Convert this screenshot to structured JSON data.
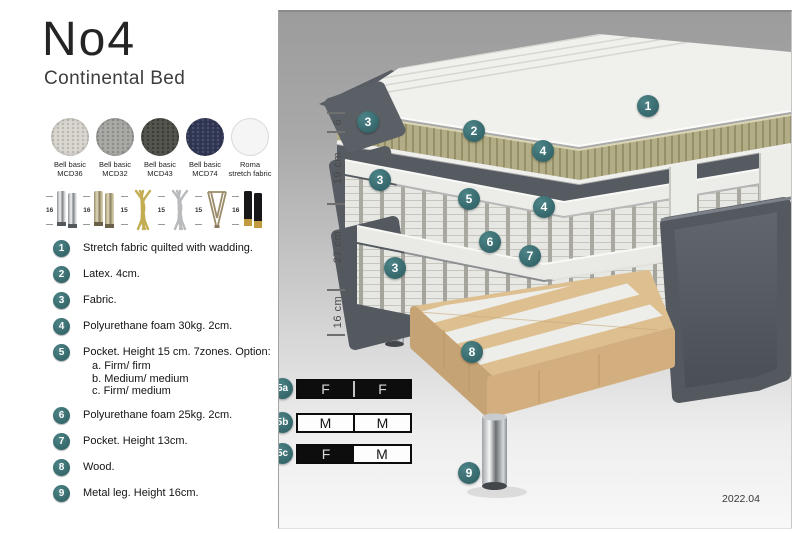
{
  "product": {
    "name": "No4",
    "type": "Continental Bed"
  },
  "fabrics": [
    {
      "name": "Bell basic",
      "code": "MCD36"
    },
    {
      "name": "Bell basic",
      "code": "MCD32"
    },
    {
      "name": "Bell basic",
      "code": "MCD43"
    },
    {
      "name": "Bell basic",
      "code": "MCD74"
    },
    {
      "name": "Roma",
      "code": "stretch fabric"
    }
  ],
  "legs": [
    {
      "height": "16",
      "style": "chrome cylinder pair"
    },
    {
      "height": "16",
      "style": "brass cylinder pair"
    },
    {
      "height": "15",
      "style": "gold twisted"
    },
    {
      "height": "15",
      "style": "silver twisted"
    },
    {
      "height": "15",
      "style": "hairpin"
    },
    {
      "height": "16",
      "style": "black with brass tip pair"
    }
  ],
  "features": [
    {
      "num": "1",
      "text": "Stretch fabric quilted with wadding."
    },
    {
      "num": "2",
      "text": "Latex. 4cm."
    },
    {
      "num": "3",
      "text": "Fabric."
    },
    {
      "num": "4",
      "text": "Polyurethane foam 30kg. 2cm."
    },
    {
      "num": "5",
      "text": "Pocket. Height 15 cm. 7zones. Option:",
      "options": [
        "a. Firm/ firm",
        "b. Medium/ medium",
        "c. Firm/ medium"
      ]
    },
    {
      "num": "6",
      "text": "Polyurethane foam 25kg. 2cm."
    },
    {
      "num": "7",
      "text": "Pocket. Height 13cm."
    },
    {
      "num": "8",
      "text": "Wood."
    },
    {
      "num": "9",
      "text": "Metal leg. Height 16cm."
    }
  ],
  "diagram": {
    "dimensions": [
      "6",
      "19 cm",
      "27 cm",
      "16 cm"
    ],
    "callouts": [
      "1",
      "2",
      "3",
      "4",
      "3",
      "5",
      "4",
      "6",
      "7",
      "3",
      "8",
      "9"
    ]
  },
  "firmness": [
    {
      "id": "5a",
      "cells": [
        {
          "label": "F",
          "variant": "dark"
        },
        {
          "label": "F",
          "variant": "dark"
        }
      ]
    },
    {
      "id": "5b",
      "cells": [
        {
          "label": "M",
          "variant": "light"
        },
        {
          "label": "M",
          "variant": "light"
        }
      ]
    },
    {
      "id": "5c",
      "cells": [
        {
          "label": "F",
          "variant": "dark"
        },
        {
          "label": "M",
          "variant": "light"
        }
      ]
    }
  ],
  "version": "2022.04",
  "colors": {
    "accent_badge": "#3b6f72",
    "fabric_dark": "#5b6066",
    "latex": "#b2ad86",
    "wood": "#ddbf90"
  }
}
